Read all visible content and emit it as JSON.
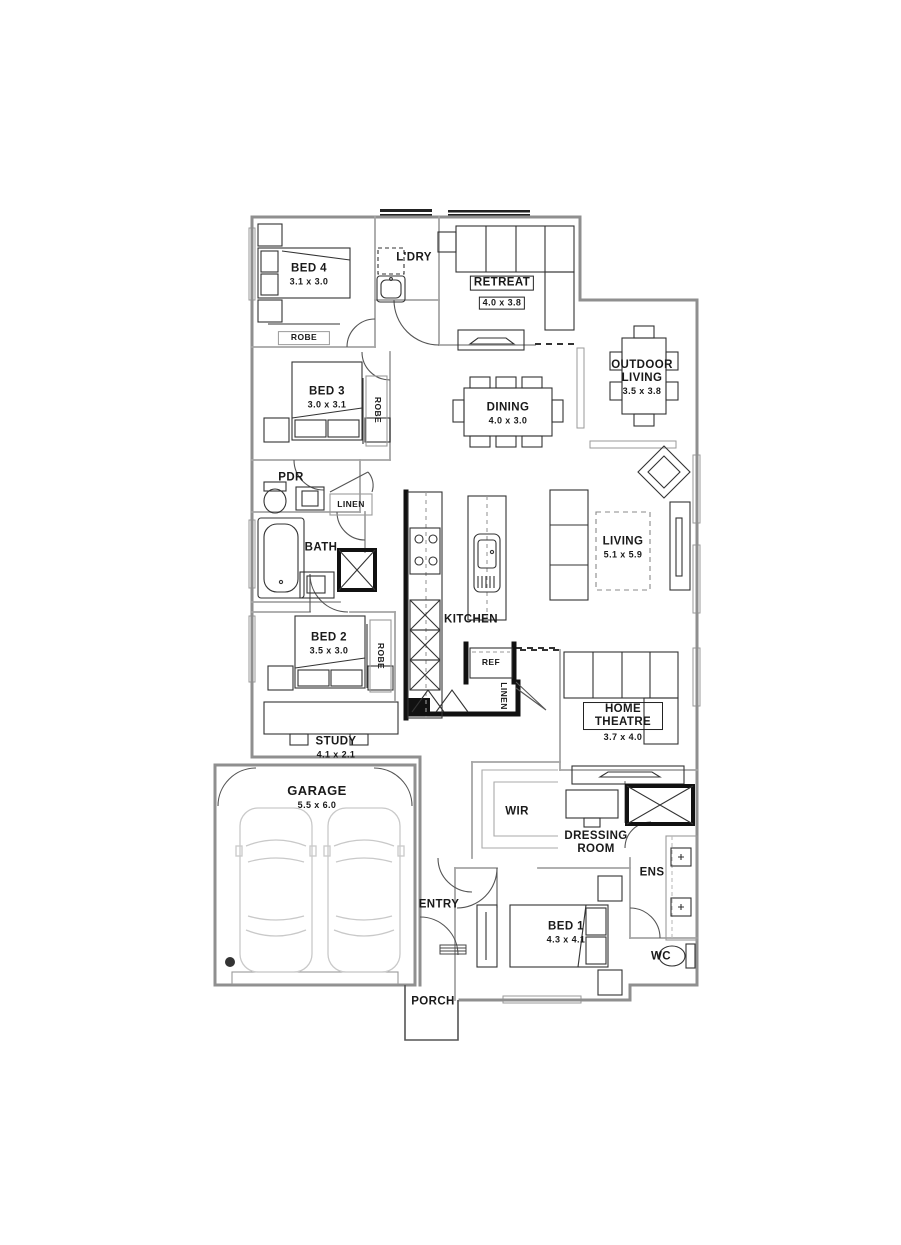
{
  "rooms": {
    "bed4": {
      "label": "BED 4",
      "dims": "3.1 x 3.0"
    },
    "ldry": {
      "label": "L'DRY"
    },
    "retreat": {
      "label": "RETREAT",
      "dims": "4.0 x 3.8"
    },
    "outdoor_living": {
      "label": "OUTDOOR LIVING",
      "dims": "3.5 x 3.8"
    },
    "bed3": {
      "label": "BED 3",
      "dims": "3.0 x 3.1"
    },
    "dining": {
      "label": "DINING",
      "dims": "4.0 x 3.0"
    },
    "pdr": {
      "label": "PDR"
    },
    "bath": {
      "label": "BATH"
    },
    "living": {
      "label": "LIVING",
      "dims": "5.1 x 5.9"
    },
    "kitchen": {
      "label": "KITCHEN"
    },
    "bed2": {
      "label": "BED 2",
      "dims": "3.5 x 3.0"
    },
    "study": {
      "label": "STUDY",
      "dims": "4.1 x 2.1"
    },
    "home_theatre": {
      "label": "HOME THEATRE",
      "dims": "3.7 x 4.0"
    },
    "garage": {
      "label": "GARAGE",
      "dims": "5.5 x 6.0"
    },
    "wir": {
      "label": "WIR"
    },
    "dressing_room": {
      "label": "DRESSING ROOM"
    },
    "ens": {
      "label": "ENS"
    },
    "entry": {
      "label": "ENTRY"
    },
    "bed1": {
      "label": "BED 1",
      "dims": "4.3 x 4.1"
    },
    "wc": {
      "label": "WC"
    },
    "porch": {
      "label": "PORCH"
    }
  },
  "fixtures": {
    "robe_bed4": "ROBE",
    "robe_bed3": "ROBE",
    "robe_bed2": "ROBE",
    "linen_bath": "LINEN",
    "linen_pantry": "LINEN",
    "ref": "REF"
  },
  "colors": {
    "wall": "#8f8f8f",
    "interior_wall": "#a5a5a5",
    "dark_wall": "#111111",
    "furniture": "#333333",
    "car": "#c9c9c9",
    "label": "#1a1a1a"
  }
}
